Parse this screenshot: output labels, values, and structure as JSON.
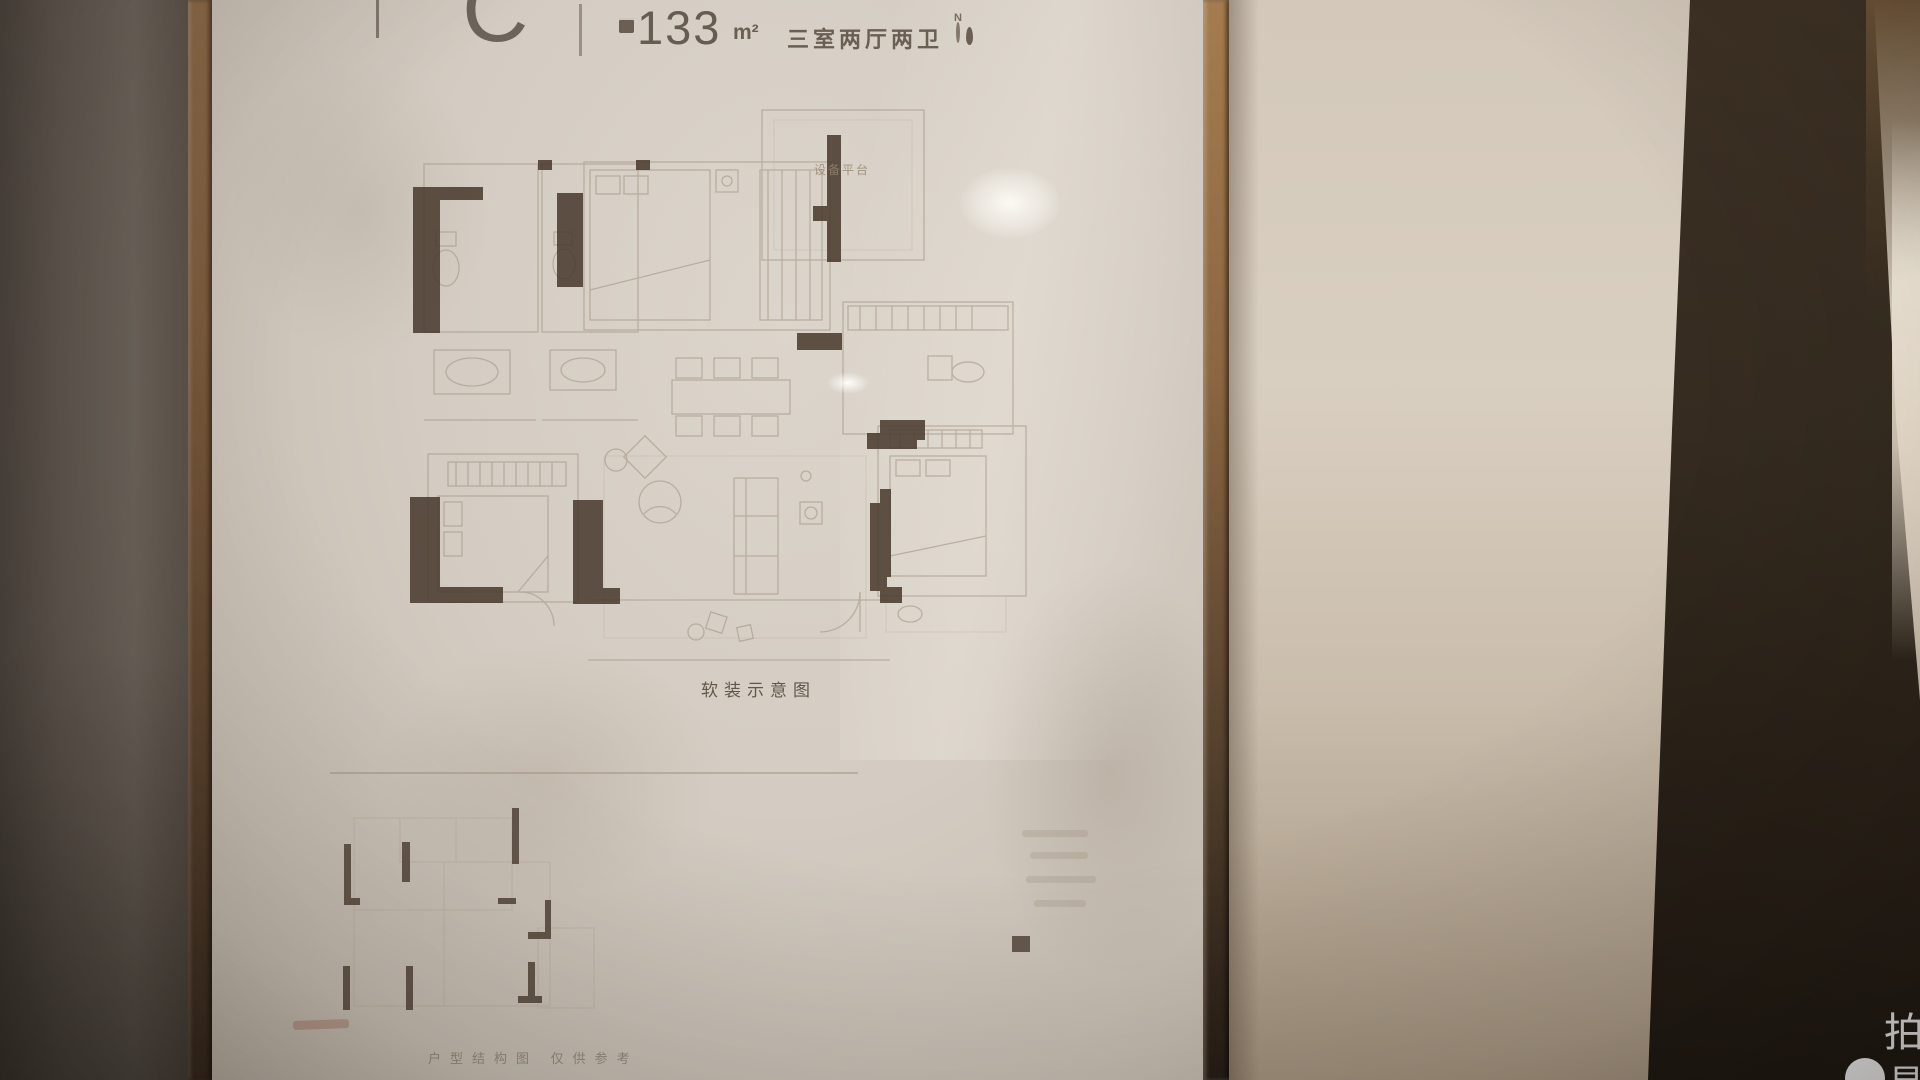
{
  "header": {
    "unit_label": "C",
    "area_value": "133",
    "area_unit": "m²",
    "layout_text": "三室两厅两卫",
    "compass_letter": "N"
  },
  "floor_plan": {
    "platform_label": "设备平台",
    "main_caption": "软装示意图",
    "secondary_caption": "户型结构图 仅供参考"
  },
  "watermark": {
    "line1": "拍",
    "line2": "易"
  },
  "colors": {
    "frame_wood": "#8a6847",
    "poster_paper": "#d7cfc6",
    "dark_band": "#2b221a",
    "plan_wall": "#4a3b2f",
    "plan_line": "#a59686",
    "header_text": "#6b5f54"
  }
}
